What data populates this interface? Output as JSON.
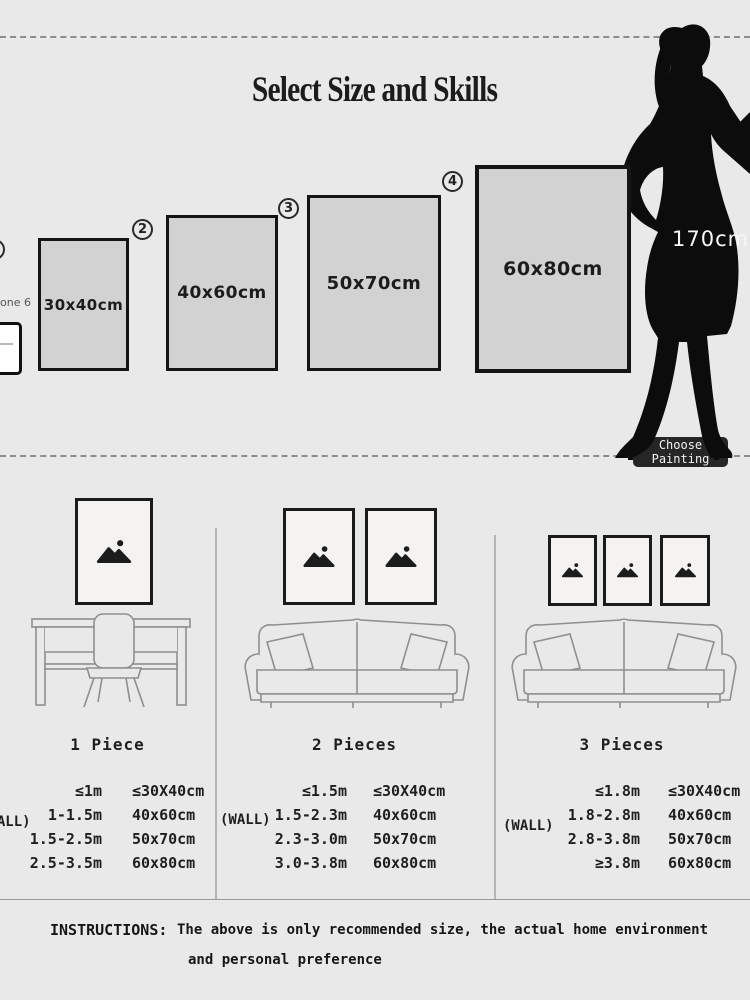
{
  "colors": {
    "background": "#e9e9e9",
    "panel_gray": "#d2d2d2",
    "ink": "#1c1c1c",
    "button_bg": "#262626"
  },
  "top": {
    "title": "Select Size and Skills",
    "phone_label": "one 6",
    "height_label": "170cm",
    "choose_button_label": "Choose Painting",
    "size_options": [
      {
        "num": "1",
        "size": "30x40cm"
      },
      {
        "num": "2",
        "size": "40x60cm"
      },
      {
        "num": "3",
        "size": "50x70cm"
      },
      {
        "num": "4",
        "size": "60x80cm"
      }
    ]
  },
  "sections": [
    {
      "title": "1 Piece",
      "wall_label": "(WALL)",
      "rows": [
        {
          "wall": "≤1m",
          "size": "≤30X40cm"
        },
        {
          "wall": "1-1.5m",
          "size": "40x60cm"
        },
        {
          "wall": "1.5-2.5m",
          "size": "50x70cm"
        },
        {
          "wall": "2.5-3.5m",
          "size": "60x80cm"
        }
      ]
    },
    {
      "title": "2 Pieces",
      "wall_label": "(WALL)",
      "rows": [
        {
          "wall": "≤1.5m",
          "size": "≤30X40cm"
        },
        {
          "wall": "1.5-2.3m",
          "size": "40x60cm"
        },
        {
          "wall": "2.3-3.0m",
          "size": "50x70cm"
        },
        {
          "wall": "3.0-3.8m",
          "size": "60x80cm"
        }
      ]
    },
    {
      "title": "3 Pieces",
      "wall_label": "(WALL)",
      "rows": [
        {
          "wall": "≤1.8m",
          "size": "≤30X40cm"
        },
        {
          "wall": "1.8-2.8m",
          "size": "40x60cm"
        },
        {
          "wall": "2.8-3.8m",
          "size": "50x70cm"
        },
        {
          "wall": "≥3.8m",
          "size": "60x80cm"
        }
      ]
    }
  ],
  "instructions": {
    "label": "INSTRUCTIONS:",
    "line1": "The above is only recommended size, the actual home environment",
    "line2": "and personal preference"
  }
}
